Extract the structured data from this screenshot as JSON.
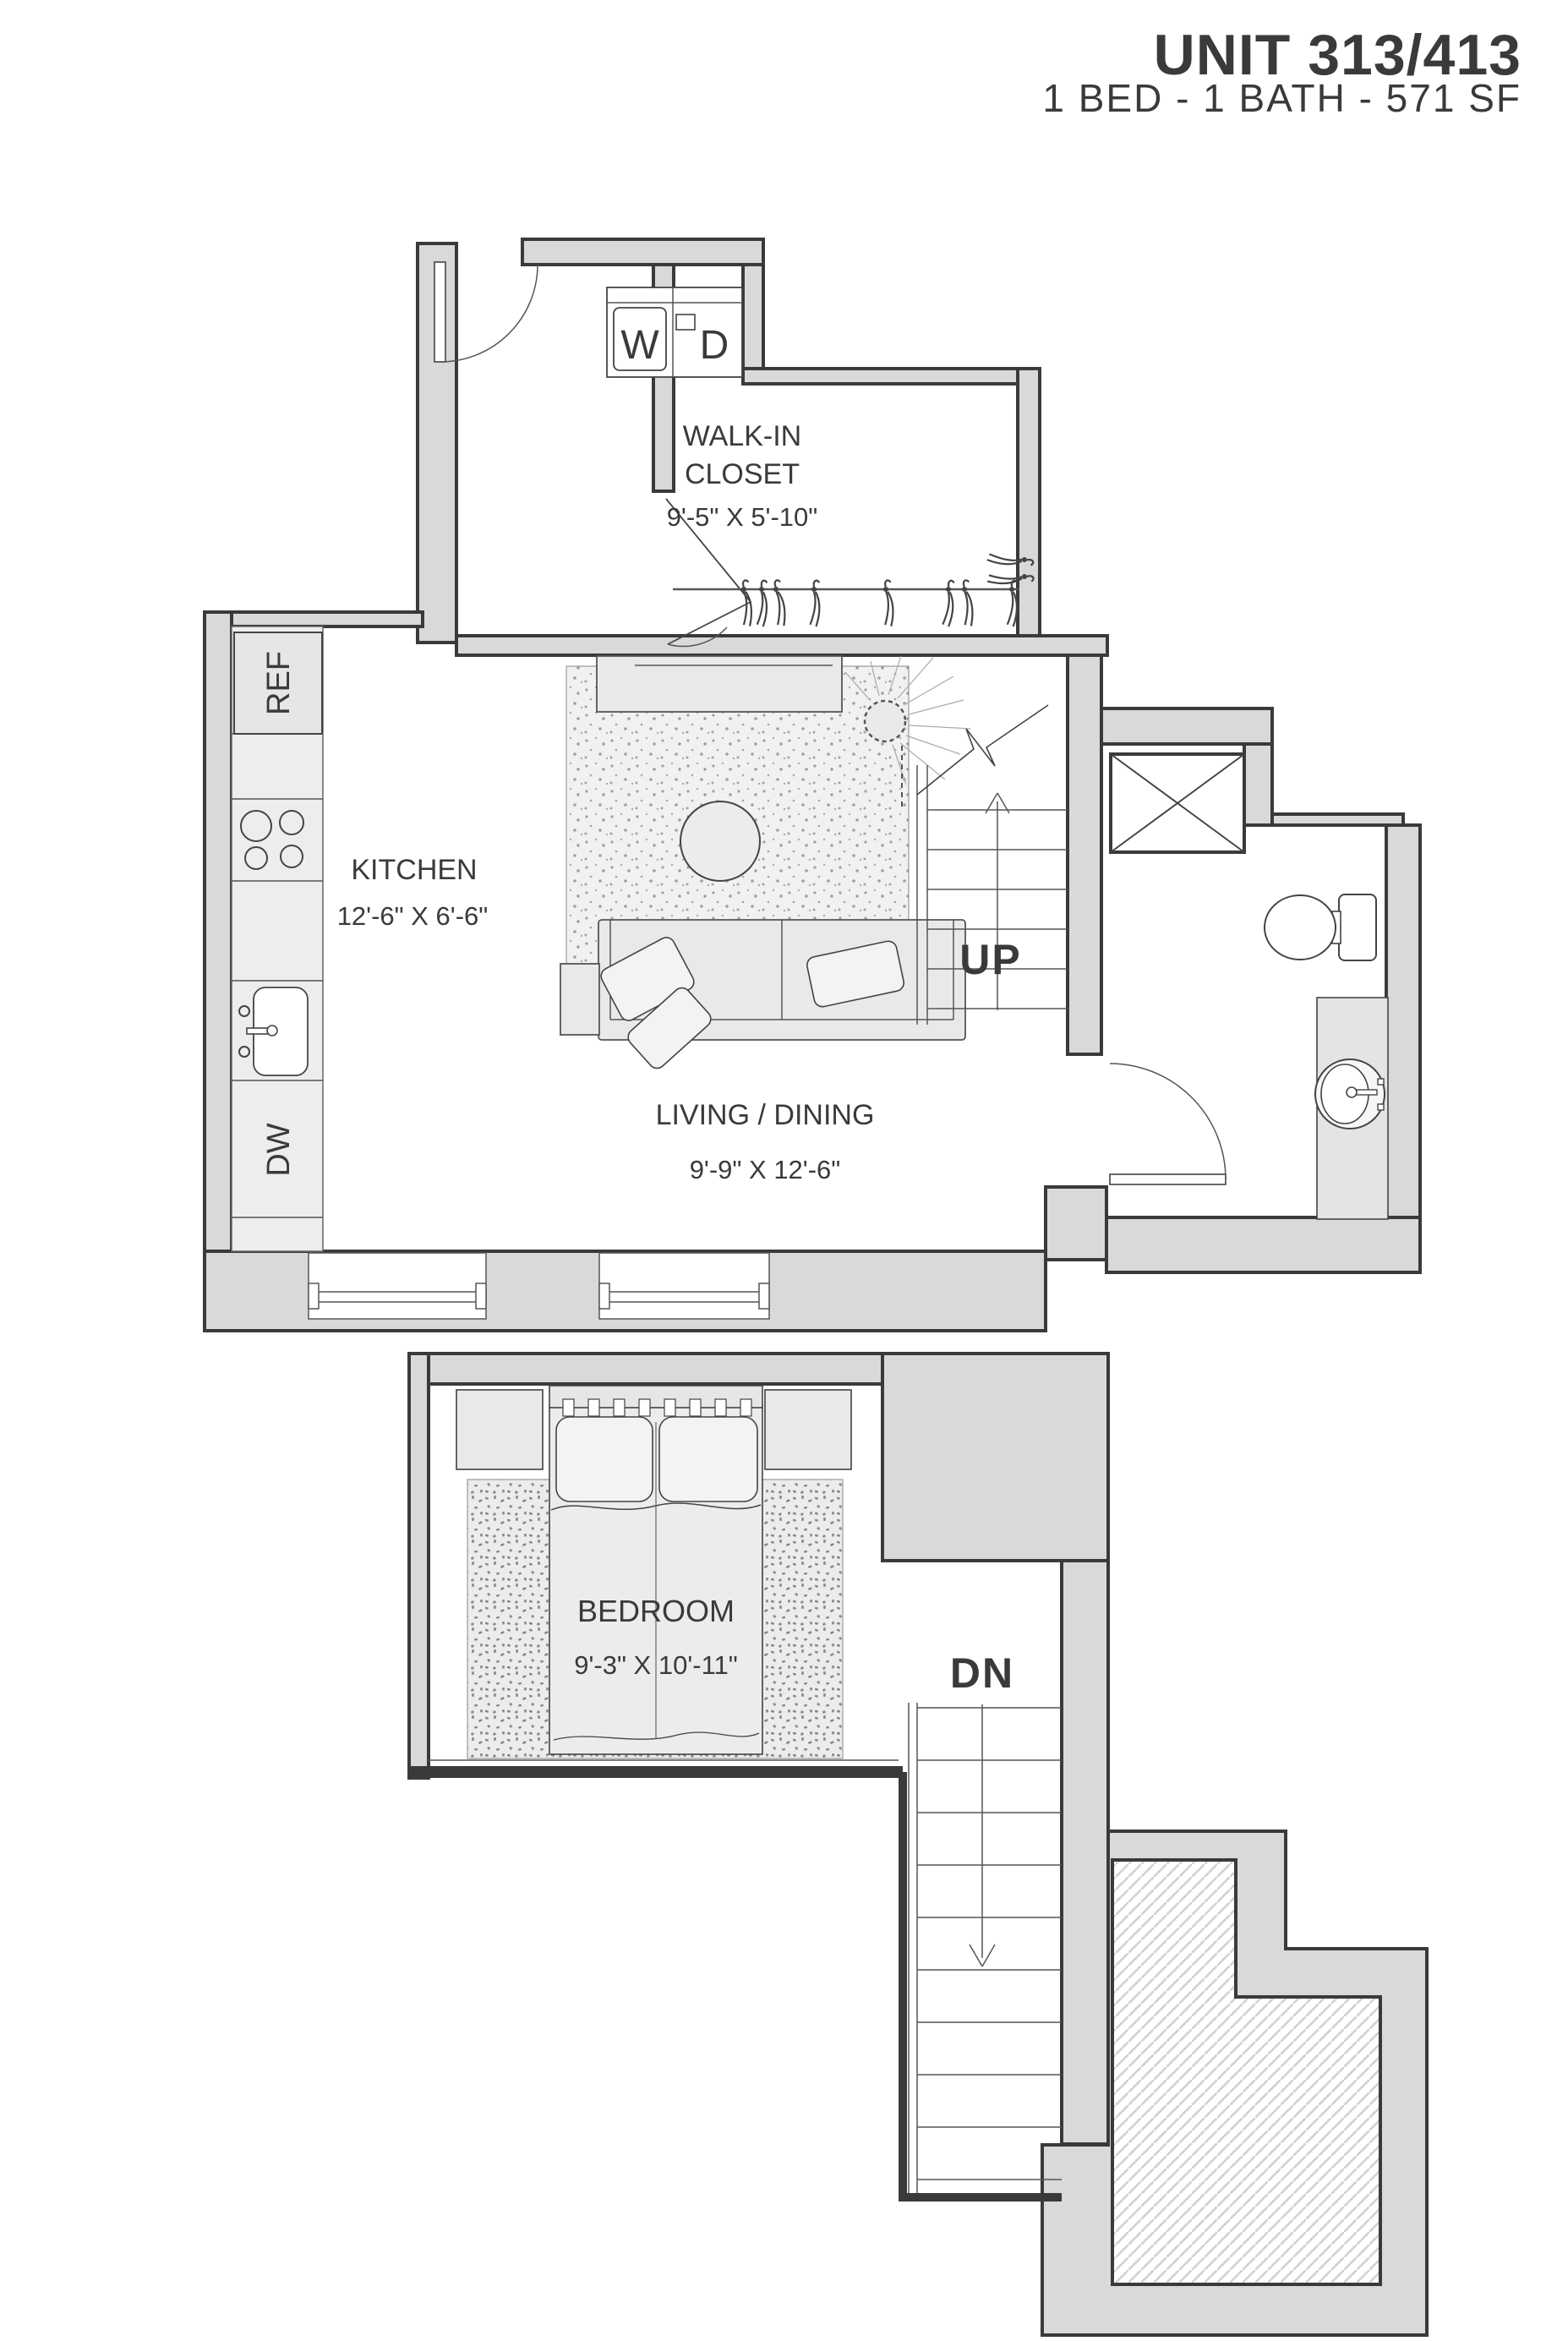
{
  "header": {
    "unit": "UNIT 313/413",
    "specs": "1 BED - 1 BATH - 571 SF"
  },
  "upper_floor": {
    "walk_in_closet": {
      "line1": "WALK-IN",
      "line2": "CLOSET",
      "dims": "9'-5\" X 5'-10\""
    },
    "kitchen": {
      "name": "KITCHEN",
      "dims": "12'-6\" X 6'-6\""
    },
    "living_dining": {
      "name": "LIVING / DINING",
      "dims": "9'-9\" X 12'-6\""
    },
    "appliances": {
      "washer": "W",
      "dryer": "D",
      "refrigerator": "REF",
      "dishwasher": "DW"
    },
    "stairs": {
      "direction": "UP"
    }
  },
  "lower_floor": {
    "bedroom": {
      "name": "BEDROOM",
      "dims": "9'-3\" X 10'-11\""
    },
    "stairs": {
      "direction": "DN"
    }
  },
  "colors": {
    "wall_fill": "#d9d9d9",
    "wall_line": "#3a3a3a",
    "furniture_fill": "#e9e9e9",
    "text": "#3a3a3a",
    "rug_stipple_living": "#a0a0a0",
    "rug_stipple_bedroom": "#8a8a8a",
    "hatch_line": "#d2d2d2"
  }
}
